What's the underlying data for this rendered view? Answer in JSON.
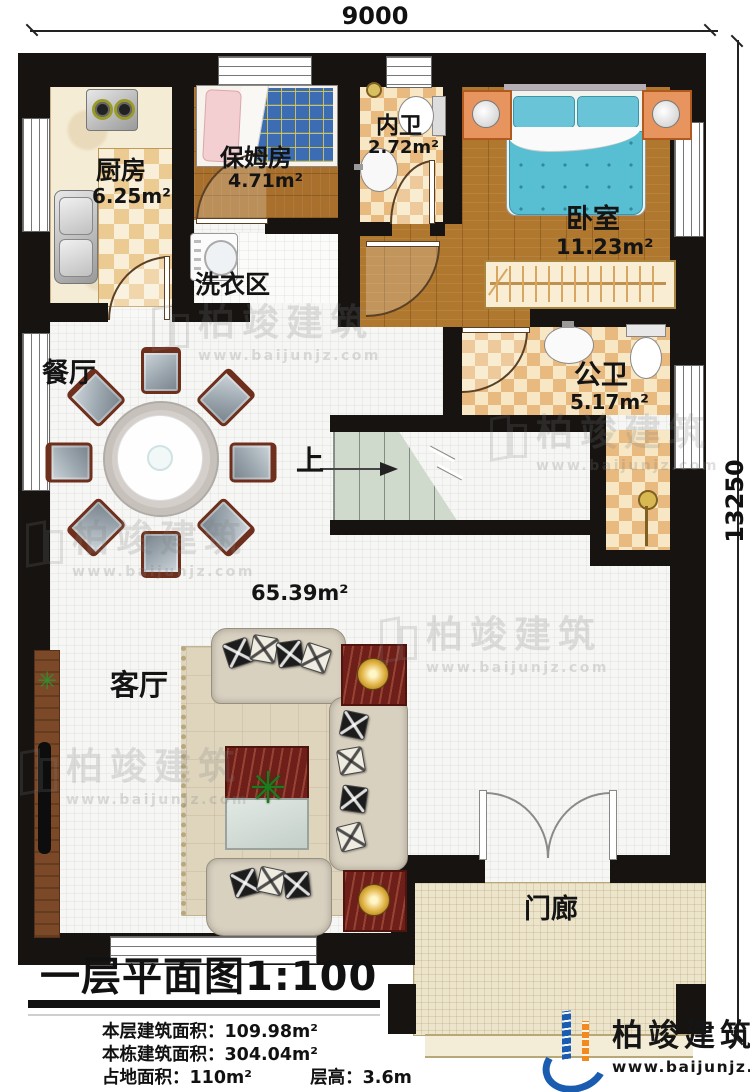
{
  "dimensions": {
    "width_label": "9000",
    "height_label": "13250"
  },
  "rooms": {
    "kitchen": {
      "name": "厨房",
      "area": "6.25m²"
    },
    "nanny_room": {
      "name": "保姆房",
      "area": "4.71m²"
    },
    "inner_bathroom": {
      "name": "内卫",
      "area": "2.72m²"
    },
    "bedroom": {
      "name": "卧室",
      "area": "11.23m²"
    },
    "laundry": {
      "name": "洗衣区"
    },
    "dining": {
      "name": "餐厅"
    },
    "public_bathroom": {
      "name": "公卫",
      "area": "5.17m²"
    },
    "living": {
      "name": "客厅",
      "area": "65.39m²"
    },
    "porch": {
      "name": "门廊"
    },
    "stairs": {
      "direction_label": "上"
    }
  },
  "title": {
    "text": "一层平面图",
    "scale": "1:100"
  },
  "stats": {
    "floor_area_label": "本层建筑面积：",
    "floor_area_value": "109.98m²",
    "building_area_label": "本栋建筑面积：",
    "building_area_value": "304.04m²",
    "land_area_label": "占地面积：",
    "land_area_value": "110m²",
    "floor_height_label": "层高：",
    "floor_height_value": "3.6m"
  },
  "watermark": {
    "brand": "柏竣建筑",
    "url": "www.baijunjz.com"
  },
  "logo": {
    "brand": "柏竣建筑",
    "url": "www.baijunjz.com"
  },
  "colors": {
    "wall": "#161310",
    "checker_tan": "#eccb92",
    "checker_orange": "#e8ba80",
    "wood": "#b0782f",
    "bed_teal": "#58bed2",
    "stair_green": "#cfd9cc",
    "porch_tile": "#ede5cb",
    "mahogany": "#6e1f1a",
    "logo_blue": "#1a5cb0",
    "logo_orange": "#f28a1e"
  }
}
